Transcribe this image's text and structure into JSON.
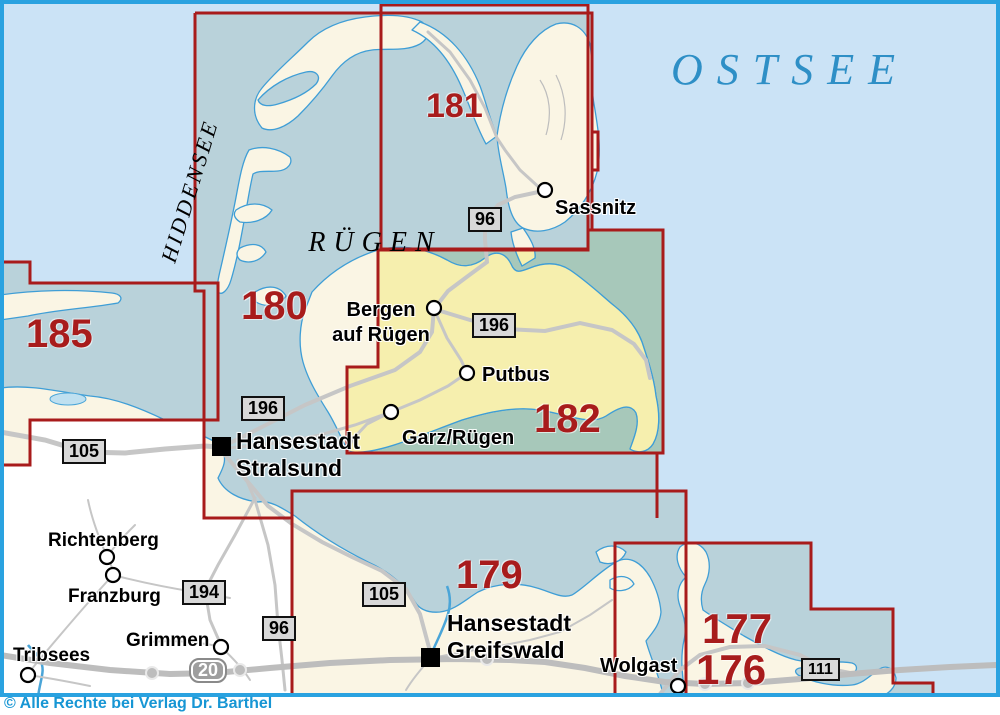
{
  "sea": {
    "name": "OSTSEE"
  },
  "regions": {
    "ruegen": "RÜGEN",
    "hiddensee": "HIDDENSEE"
  },
  "sheets": {
    "s185": "185",
    "s180": "180",
    "s181": "181",
    "s182": "182",
    "s179": "179",
    "s177": "177",
    "s176": "176"
  },
  "towns": {
    "sassnitz": "Sassnitz",
    "bergen_line1": "Bergen",
    "bergen_line2": "auf Rügen",
    "putbus": "Putbus",
    "garz": "Garz/Rügen",
    "stralsund_line1": "Hansestadt",
    "stralsund_line2": "Stralsund",
    "richtenberg": "Richtenberg",
    "franzburg": "Franzburg",
    "tribsees": "Tribsees",
    "grimmen": "Grimmen",
    "greifswald_line1": "Hansestadt",
    "greifswald_line2": "Greifswald",
    "wolgast": "Wolgast"
  },
  "road_badges": {
    "b96_north": "96",
    "b196_ruegen": "196",
    "b196_stralsund": "196",
    "b105_west": "105",
    "b194": "194",
    "b96_south": "96",
    "b105_east": "105",
    "b111": "111",
    "a20": "20"
  },
  "footer": {
    "copyright": "© Alle Rechte bei Verlag Dr. Barthel"
  },
  "colors": {
    "sheet_line": "#a81b1b",
    "sheet_number": "#a81c1c",
    "open_sea": "#cbe3f6",
    "sheet_water": "#b9d2da",
    "highlight_water": "#a7c8ba",
    "highlight_land": "#f6efae",
    "sheet_land": "#faf5e4",
    "outside_land": "#ffffff",
    "frame": "#2aa2e0",
    "copyright_text": "#1796d4"
  }
}
